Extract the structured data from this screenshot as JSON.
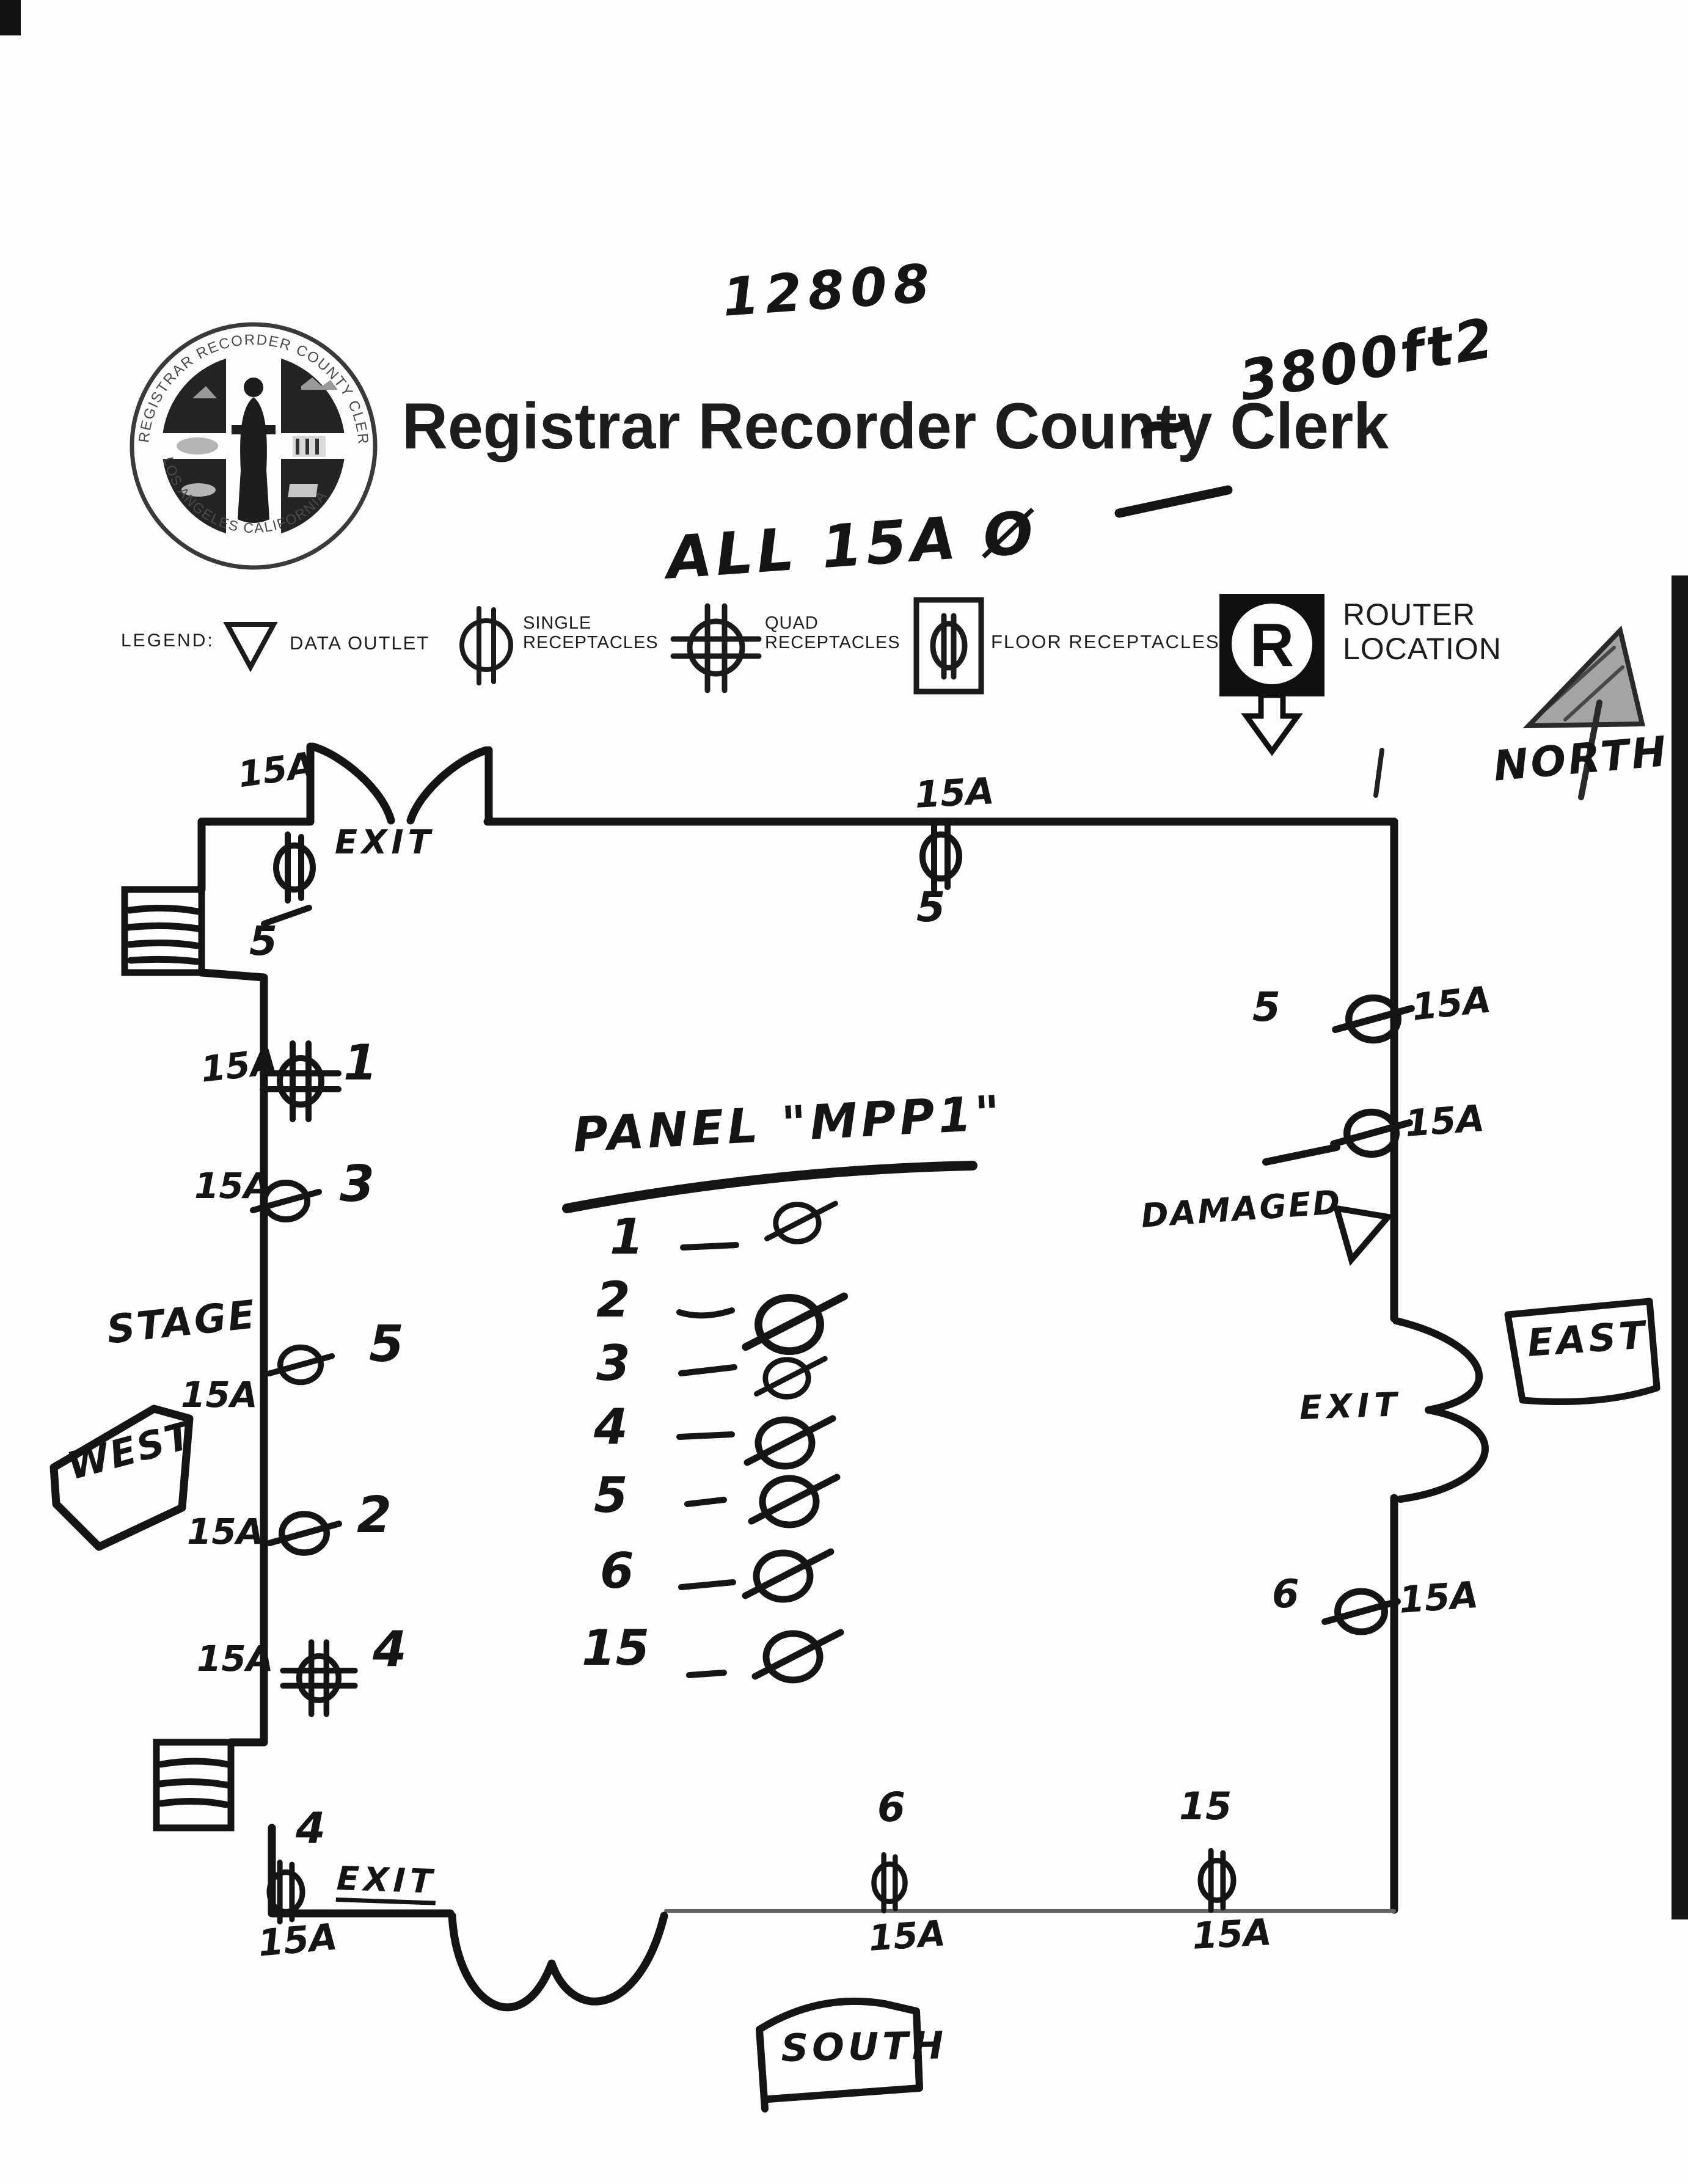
{
  "header": {
    "doc_number": "12808",
    "approx_symbol": "~",
    "area_note": "3800ft2",
    "title": "Registrar Recorder County Clerk",
    "amps_note": "ALL 15A Ø"
  },
  "seal": {
    "ring_top": "REGISTRAR RECORDER COUNTY CLERK",
    "ring_bottom": "LOS ANGELES CALIFORNIA"
  },
  "legend": {
    "label": "LEGEND:",
    "data_outlet": "DATA OUTLET",
    "single_receptacles": "SINGLE RECEPTACLES",
    "quad_receptacles": "QUAD RECEPTACLES",
    "floor_receptacles": "FLOOR RECEPTACLES",
    "router_location": "ROUTER LOCATION",
    "router_letter": "R"
  },
  "compass": {
    "north": "NORTH"
  },
  "plan": {
    "panel": {
      "title": "PANEL \"MPP1\"",
      "circuits": [
        "1",
        "2",
        "3",
        "4",
        "5",
        "6",
        "15"
      ]
    },
    "boxes": {
      "west": "WEST",
      "east": "EAST",
      "south": "SOUTH"
    },
    "stage": "STAGE",
    "damaged": "DAMAGED",
    "exits": {
      "north": "EXIT",
      "east": "EXIT",
      "south": "EXIT"
    },
    "outlets": {
      "north_door": {
        "amps": "15A",
        "number": "5"
      },
      "north_mid": {
        "amps": "15A",
        "number": "5"
      },
      "east_upper": {
        "number": "5",
        "amps": "15A"
      },
      "east_damaged": {
        "amps": "15A"
      },
      "east_lower": {
        "number": "6",
        "amps": "15A"
      },
      "west_1": {
        "amps": "15A",
        "number": "1"
      },
      "west_3": {
        "amps": "15A",
        "number": "3"
      },
      "stage_5": {
        "amps": "15A",
        "number": "5"
      },
      "west_2": {
        "amps": "15A",
        "number": "2"
      },
      "west_4": {
        "amps": "15A",
        "number": "4"
      },
      "south_exit": {
        "number": "4",
        "amps": "15A"
      },
      "south_mid": {
        "number": "6",
        "amps": "15A"
      },
      "south_right": {
        "number": "15",
        "amps": "15A"
      }
    }
  }
}
